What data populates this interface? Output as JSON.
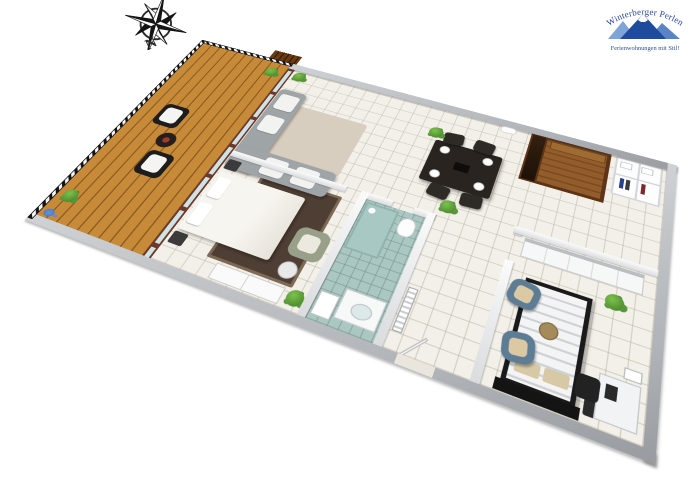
{
  "page": {
    "background": "#ffffff",
    "description": "3D isometric floor-plan rendering of a holiday apartment"
  },
  "compass": {
    "label": "N",
    "colors": {
      "star_dark": "#141414",
      "star_light": "#fbfbfb",
      "ring": "#2c2c2c"
    }
  },
  "logo": {
    "brand": "Winterberger Perlen",
    "tagline": "Ferienwohnungen mit Stil!",
    "colors": {
      "text": "#27449c",
      "mountain_left": "#7fa5d8",
      "mountain_main": "#1f4b9e",
      "mountain_right": "#5b84c4",
      "snow": "#ffffff"
    }
  },
  "floorplan": {
    "view": "3d-isometric",
    "rooms": [
      {
        "id": "balcony",
        "floor": "wood-deck",
        "furniture": [
          "striped railing",
          "two dark armchairs with white cushions",
          "round side table",
          "potted plants",
          "blue flower box"
        ]
      },
      {
        "id": "living-dining-room",
        "floor": "white-tile",
        "furniture": [
          "L-shaped grey sofa with white cushions",
          "dark coffee table on beige rug",
          "wall tv",
          "navy kitchenette",
          "fridge",
          "dining table with four plates",
          "four dining chairs",
          "potted plants"
        ]
      },
      {
        "id": "bedroom-1",
        "floor": "white-tile",
        "furniture": [
          "double bed with white bedding",
          "dark patterned rug",
          "two nightstands",
          "sage armchair",
          "round stool",
          "white wardrobe",
          "potted plant"
        ]
      },
      {
        "id": "bathroom",
        "floor": "aqua-tile",
        "furniture": [
          "glass shower",
          "toilet",
          "vanity with basin",
          "laundry unit",
          "radiator"
        ]
      },
      {
        "id": "hallway",
        "floor": "white-tile",
        "furniture": [
          "radiator",
          "entry door",
          "potted plant",
          "wall lamp"
        ]
      },
      {
        "id": "sauna",
        "floor": "wood",
        "furniture": [
          "wood benches",
          "dark glass door"
        ]
      },
      {
        "id": "wardrobe-shelf",
        "floor": "white-tile",
        "furniture": [
          "open shelf with hanging clothes and boxes"
        ]
      },
      {
        "id": "bedroom-2",
        "floor": "white-tile",
        "furniture": [
          "double bed with striped duvet and dark frame",
          "dark headboard",
          "long white wardrobe",
          "two blue armchairs with beige cushions",
          "round wooden table",
          "nightstand",
          "desk with mirror",
          "desk chair",
          "potted plant"
        ]
      }
    ],
    "palette": {
      "outer_wall": "#b6babe",
      "inner_wall": "#f2f2f2",
      "tile_floor": "#f3f0e9",
      "tile_line": "#dcd6c9",
      "wood_deck": "#c0832f",
      "bath_floor": "#abc7c1",
      "sofa": "#9fa4a7",
      "rug_living": "#d8cec0",
      "rug_bedroom": "#4e3e34",
      "coffee_table": "#33241b",
      "kitchen_unit": "#2c3c55",
      "dining_set": "#2b2520",
      "sauna_wood": "#7c4b22",
      "bed2_frame": "#1a1a1a",
      "armchair_blue": "#5d7d95",
      "armchair_sage": "#99a089",
      "railing_dark": "#141414",
      "plant_green": "#4c8a2e",
      "glass_door_frame": "#6e392b"
    }
  }
}
